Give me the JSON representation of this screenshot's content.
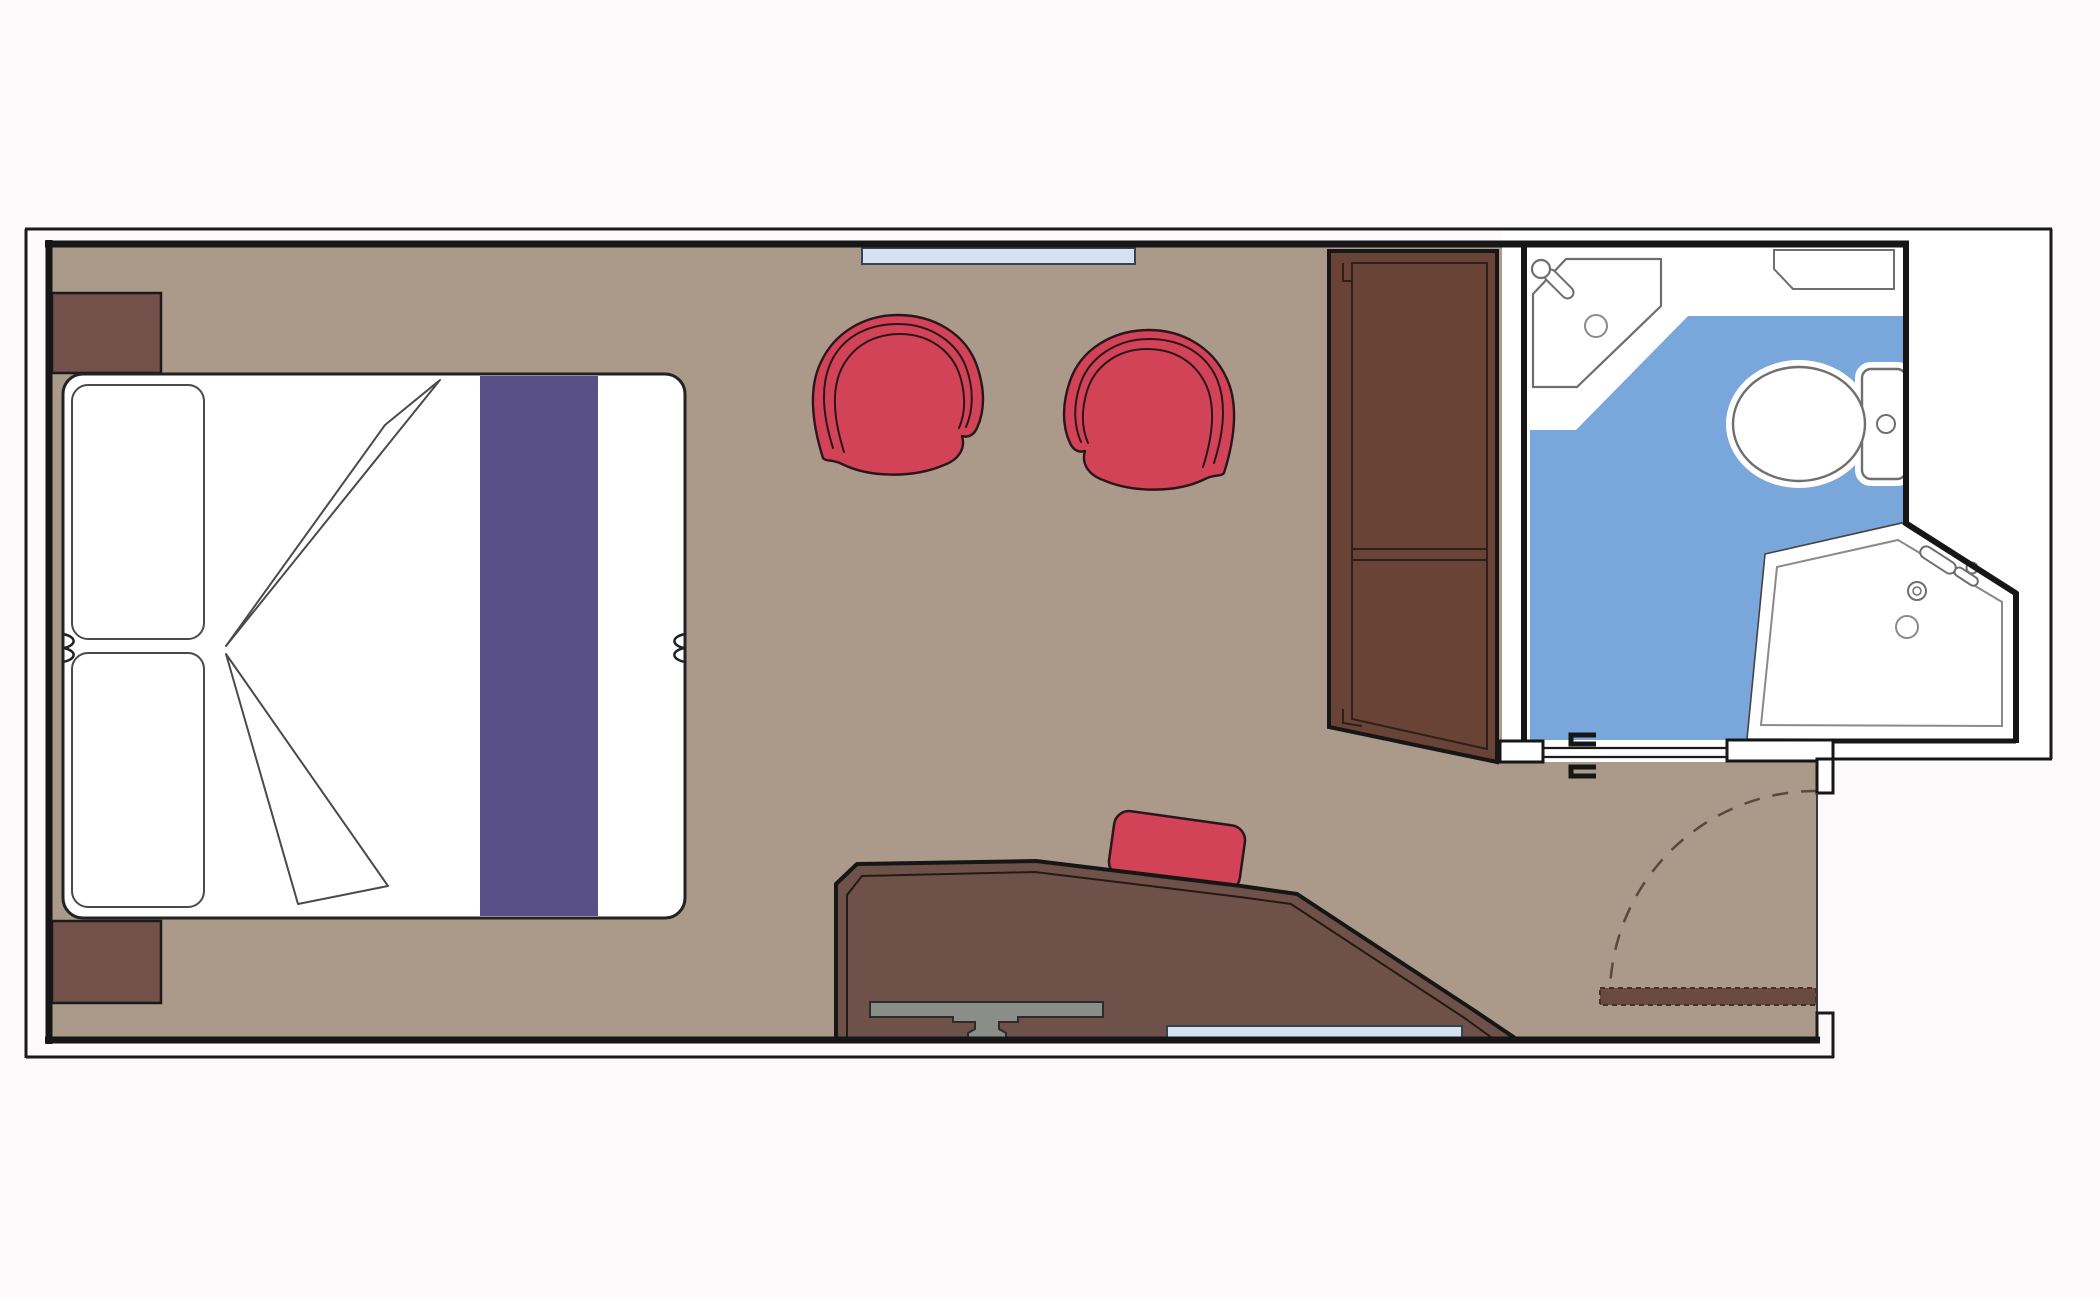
{
  "title": "cabin-floor-plan",
  "palette": {
    "background": "#fcfafb",
    "floor": "#ab998a",
    "wall": "#161616",
    "outline": "#1a1a1a",
    "bed_white": "#ffffff",
    "bed_outline": "#222222",
    "soft_outline": "#4a4a4a",
    "runner": "#585087",
    "nightstand": "#73504a",
    "wardrobe": "#6a4337",
    "wardrobe_line": "#2e1f18",
    "desk": "#6e5249",
    "desk_line": "#241a14",
    "chair_red": "#d24357",
    "chair_outline": "#2a161a",
    "grey_bracket": "#8b8d89",
    "grey_bracket_line": "#2c2c2c",
    "glass": "#d4e3f4",
    "glass_line": "#39424e",
    "bath_blue": "#7aa7db",
    "fixture": "#6f6f6f",
    "fixture_soft": "#8a8a8a",
    "threshold": "#6b4a40",
    "threshold_line": "#42332a",
    "arc_dash": "#57493d"
  },
  "furniture": [
    {
      "name": "double-bed"
    },
    {
      "name": "pillow-upper"
    },
    {
      "name": "pillow-lower"
    },
    {
      "name": "bed-runner"
    },
    {
      "name": "nightstand-upper"
    },
    {
      "name": "nightstand-lower"
    },
    {
      "name": "lounge-chair-left"
    },
    {
      "name": "lounge-chair-right"
    },
    {
      "name": "wardrobe"
    },
    {
      "name": "desk"
    },
    {
      "name": "desk-chair"
    },
    {
      "name": "tv-bracket"
    },
    {
      "name": "window-top"
    },
    {
      "name": "window-bottom"
    },
    {
      "name": "bathroom"
    },
    {
      "name": "corner-sink"
    },
    {
      "name": "vanity-shelf"
    },
    {
      "name": "toilet"
    },
    {
      "name": "shower"
    },
    {
      "name": "sliding-door"
    },
    {
      "name": "entrance-door-leaf"
    },
    {
      "name": "door-swing-arc"
    }
  ]
}
